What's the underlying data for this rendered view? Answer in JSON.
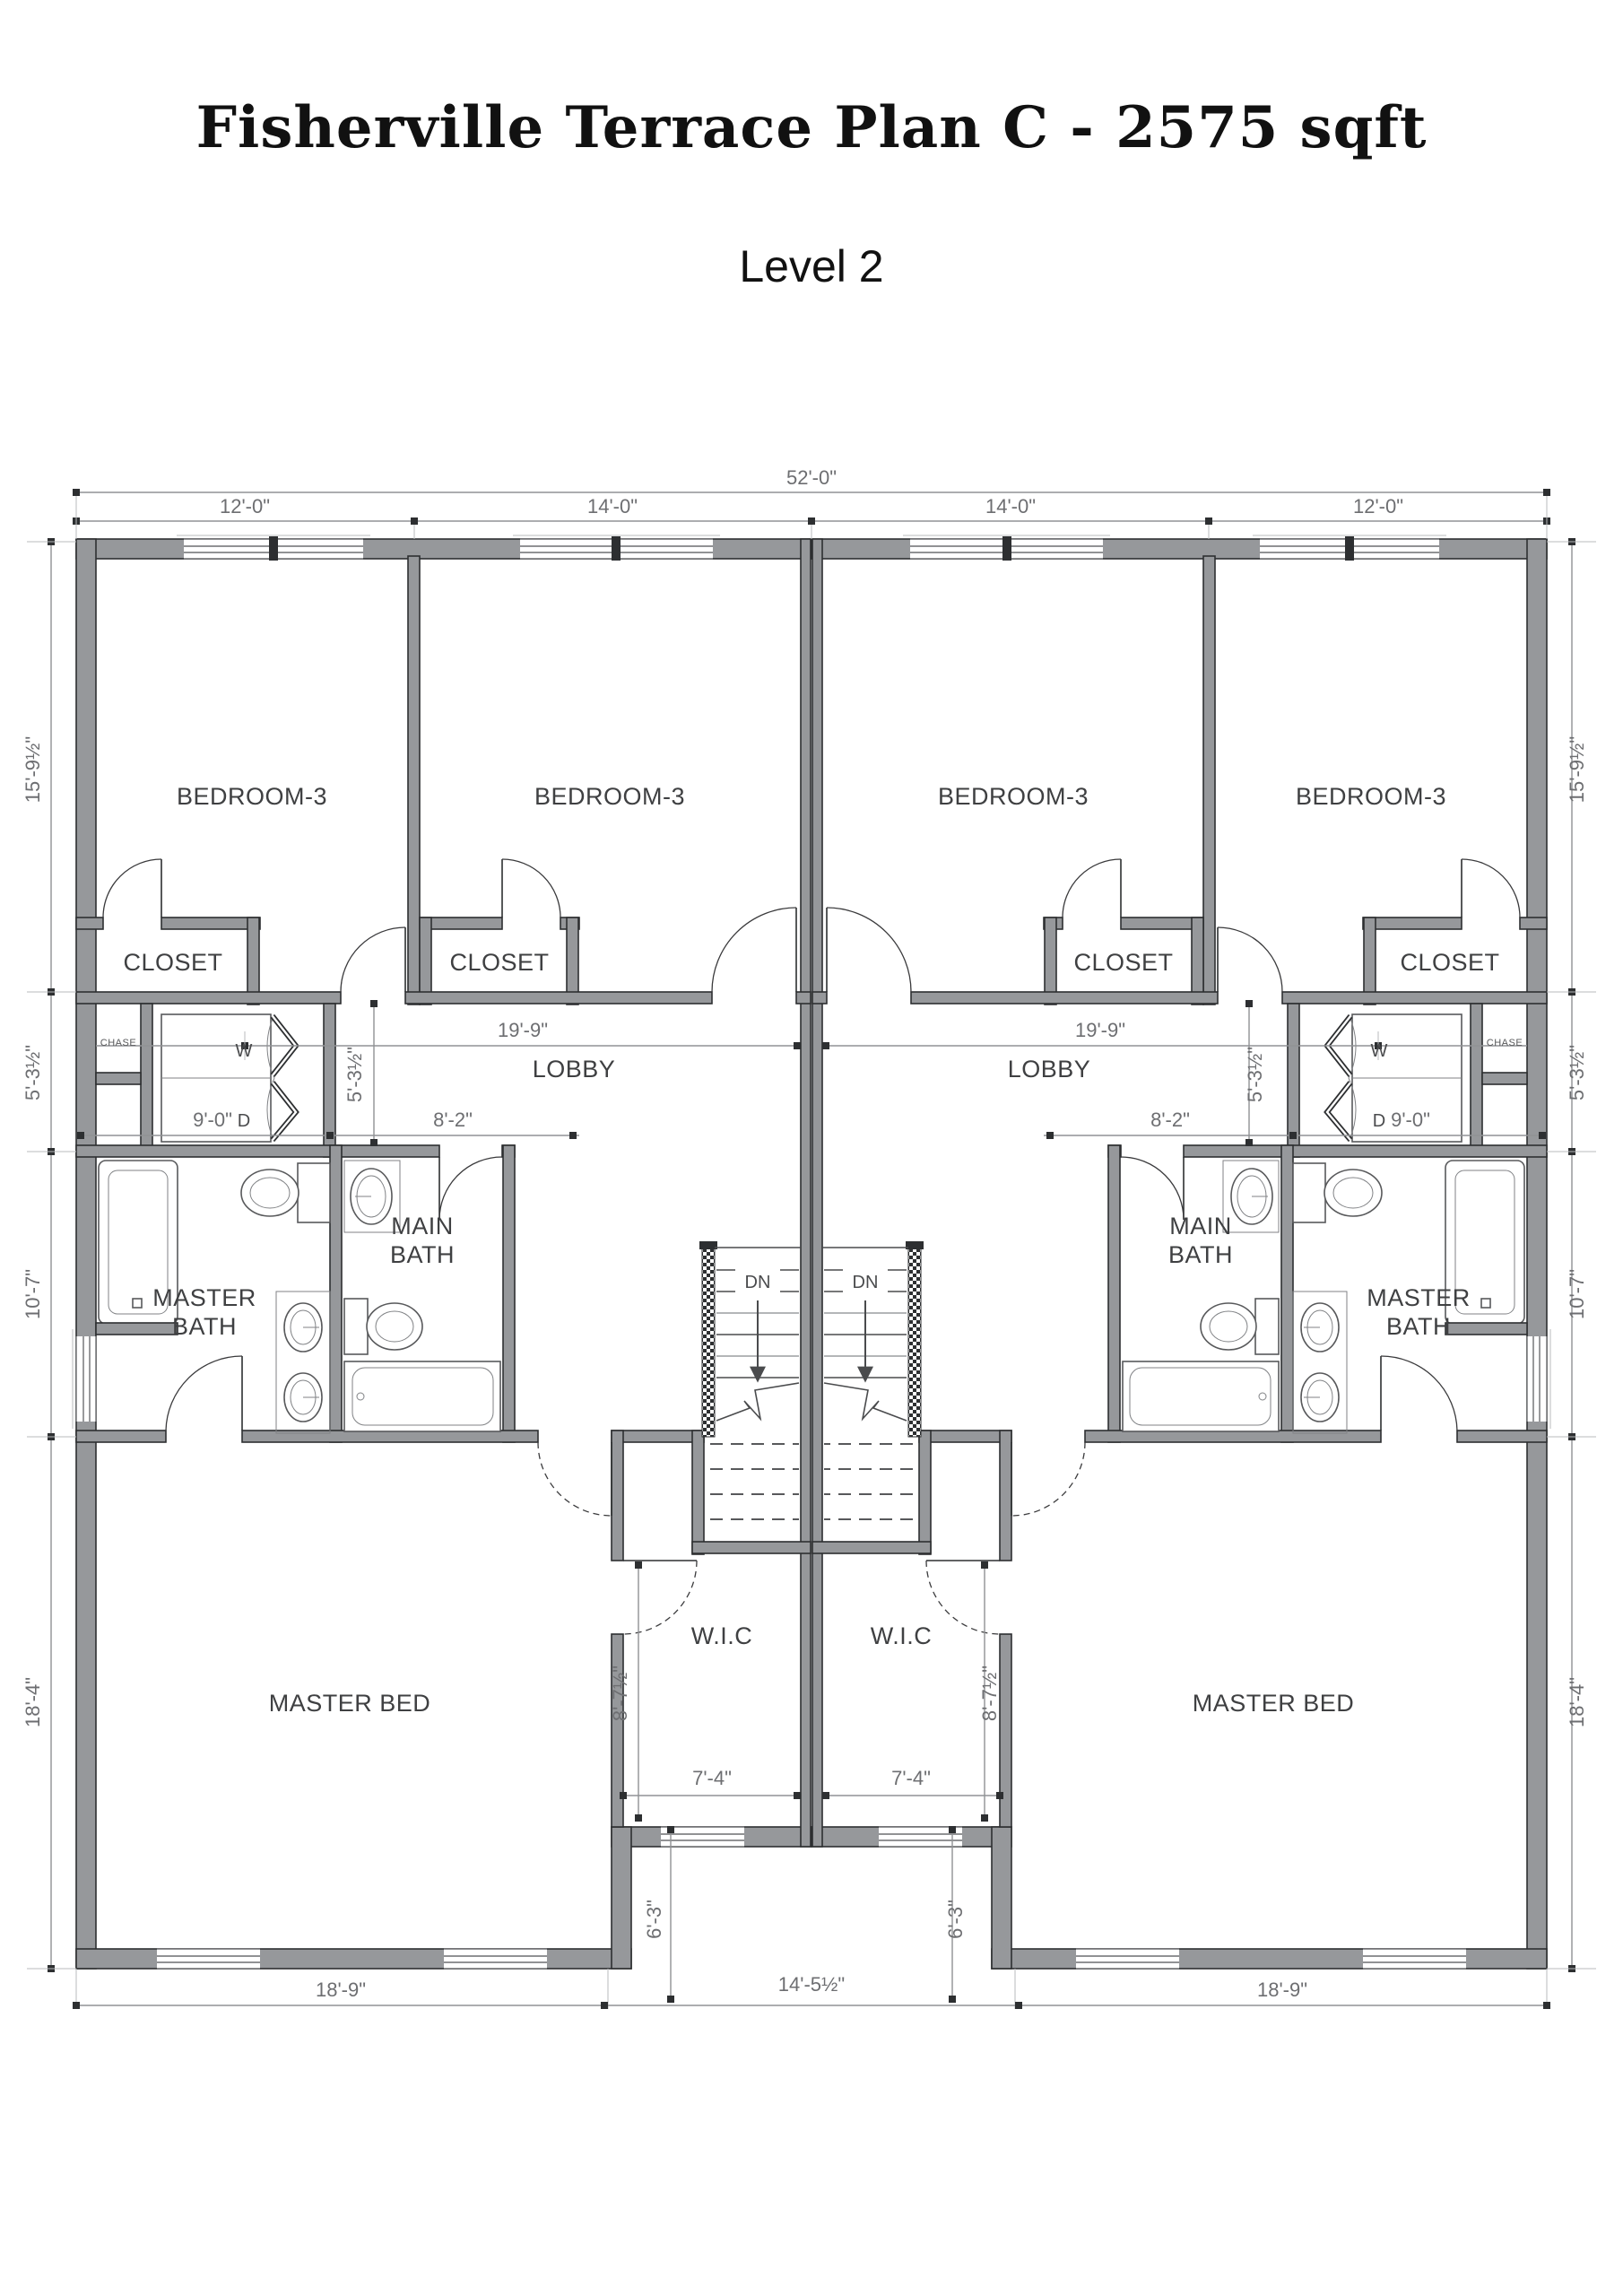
{
  "header": {
    "title": "Fisherville Terrace Plan C - 2575 sqft",
    "subtitle": "Level 2"
  },
  "chart_type": "floor-plan",
  "dims": {
    "overall_width": "52'-0\"",
    "top_left_a": "12'-0\"",
    "top_left_b": "14'-0\"",
    "top_right_b": "14'-0\"",
    "top_right_a": "12'-0\"",
    "side_1": "15'-9½\"",
    "side_2": "5'-3½\"",
    "side_3": "10'-7\"",
    "side_4": "18'-4\"",
    "bottom_left": "18'-9\"",
    "bottom_mid": "14'-5½\"",
    "bottom_right": "18'-9\"",
    "lobby_width": "19'-9\"",
    "lobby_height": "5'-3½\"",
    "laundry_width": "9'-0\"",
    "vanity_width": "8'-2\"",
    "wic_depth": "8'-7½\"",
    "wic_width": "7'-4\"",
    "wic_offset": "6'-3\""
  },
  "rooms": {
    "bedroom": "BEDROOM-3",
    "closet": "CLOSET",
    "chase": "CHASE",
    "lobby": "LOBBY",
    "main_bath_1": "MAIN",
    "main_bath_2": "BATH",
    "master_bath_1": "MASTER",
    "master_bath_2": "BATH",
    "master_bed": "MASTER BED",
    "wic": "W.I.C",
    "washer": "W",
    "dryer": "D",
    "down": "DN"
  },
  "colors": {
    "wall_fill": "#96989b",
    "wall_edge": "#2d2f31",
    "dimension": "#6d6e71",
    "label_text": "#3f4042",
    "background": "#ffffff"
  }
}
